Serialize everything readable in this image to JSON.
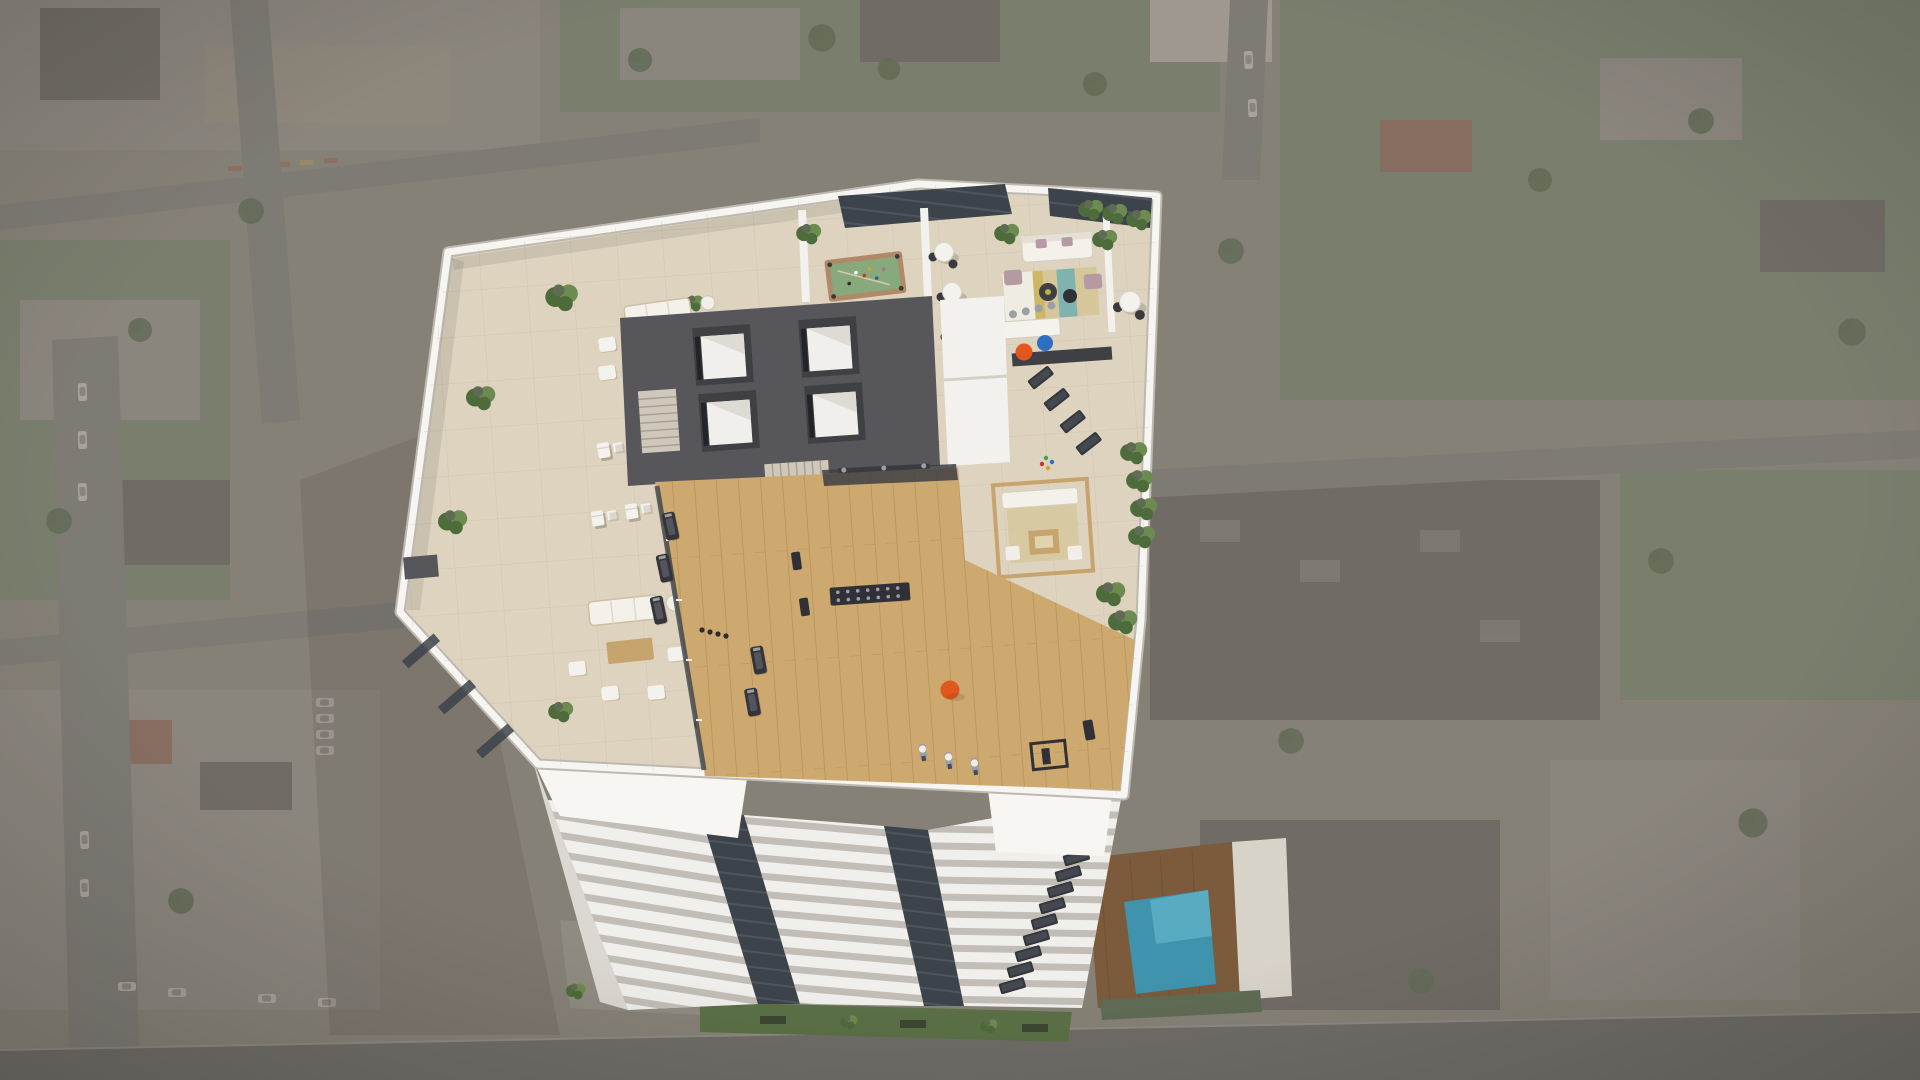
{
  "scene": {
    "subject": "Aerial 3D rendering of a white residential high-rise tower rooftop amenity deck, bird's-eye oblique view, surrounding city blocks faded and desaturated",
    "zones": [
      {
        "name": "west-lounge-terrace",
        "items": [
          "2 sofa lounge groups with wood coffee tables and white poufs",
          "6 deck chairs with side tables in 2 rows",
          "planters along parapet",
          "glass windbreak panels"
        ]
      },
      {
        "name": "games-area",
        "items": [
          "green billiards table with balls and cue",
          "blue table-tennis table with red paddles",
          "3 white bistro tables with black chairs",
          "dark glazed skylight strips"
        ]
      },
      {
        "name": "indoor-lounge",
        "items": [
          "white sofa with mauve cushions",
          "2 round black coffee tables",
          "striped area rug",
          "kitchen island with 4 bar stools",
          "dark back counter"
        ]
      },
      {
        "name": "east-terrace",
        "items": [
          "round dining table",
          "orange exercise ball",
          "blue exercise ball",
          "4 dark yoga mats",
          "timber pergola lounge",
          "tropical planters and hedges"
        ]
      },
      {
        "name": "core",
        "items": [
          "4 elevator shafts in 2x2 grid",
          "2 staircases",
          "service rooms"
        ]
      },
      {
        "name": "fitness-center",
        "items": [
          "light oak floor",
          "treadmills",
          "dumbbell rack",
          "weight benches",
          "3 white spin bikes",
          "squat rack",
          "orange exercise ball"
        ]
      }
    ],
    "ground_level": [
      "green lawn strip with planters",
      "small furnished courtyard",
      "timber pool deck",
      "turquoise swimming pool",
      "grey street"
    ],
    "counts": {
      "elevators": 4,
      "deck_chairs": 6,
      "bistro_tables": 3,
      "yoga_mats": 4,
      "spin_bikes": 3,
      "window_slots": 10
    }
  },
  "colors": {
    "bgBase": "#8a8478",
    "blockA": "#948c7e",
    "blockB": "#8f8a80",
    "blockC": "#6e6a62",
    "blockRed": "#8c6c5b",
    "green": "#79806c",
    "greenDark": "#5f6b54",
    "road": "#7f7c75",
    "tree": "#5c6950",
    "carBody": "#b5b0a6",
    "deck": "#ddd3bf",
    "deckLine": "#c4b9a4",
    "parapet": "#f6f5f1",
    "parapetShade": "#bdb9b1",
    "wallWhite": "#f2f1ed",
    "wallShade": "#d8d5ce",
    "coreGray": "#56565b",
    "coreDark": "#3f4044",
    "glass": "#3c434b",
    "glassLine": "#5a656f",
    "wood": "#cda96f",
    "woodDark": "#ab8350",
    "felt": "#87a97b",
    "feltFrame": "#b08968",
    "pingpong": "#2e5fa3",
    "accentRed": "#c23b2a",
    "ballOrange": "#e2571d",
    "ballBlue": "#2e6fc2",
    "plant": "#4e6b3b",
    "plantLight": "#6d8a50",
    "sofaWhite": "#f3f1ea",
    "cushion": "#b59aa4",
    "woodFurn": "#c7a36e",
    "rugTeal": "#7fb3b0",
    "rugSand": "#d6c79a",
    "equipDark": "#303036",
    "metal": "#9aa0a6",
    "poolWater": "#3f93ad",
    "poolLight": "#6fc0d2",
    "deckWood": "#7b5b3c",
    "lawn": "#5b7046",
    "street": "#6f6c67",
    "facadeWhite": "#f1efeb",
    "facadeStripe": "#c2beb7",
    "slotDark": "#383d44",
    "sage": "#9fac94",
    "paving": "#8f8b81",
    "shadow": "rgba(45,40,33,0.25)"
  }
}
